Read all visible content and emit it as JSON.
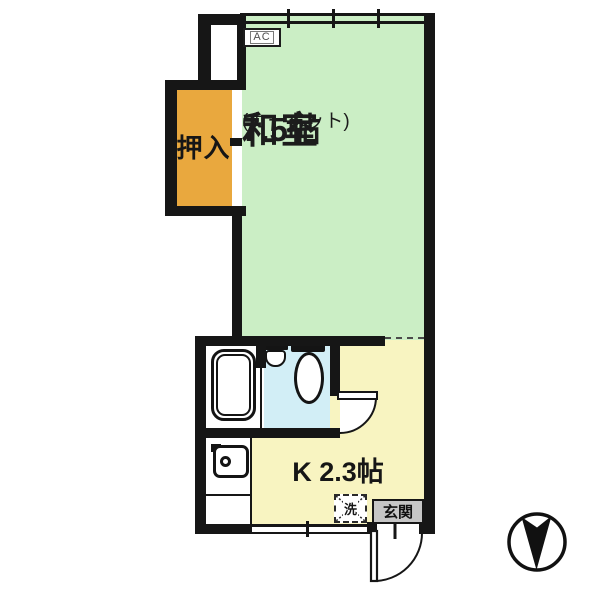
{
  "plan_type": "apartment-floor-plan",
  "labels": {
    "ac": "AC",
    "closet": "押入",
    "washer": "洗",
    "entrance": "玄関"
  },
  "rooms": {
    "washitsu": {
      "name": "和室",
      "note": "(カーペット)",
      "size": "7.5帖"
    },
    "kitchen": {
      "label": "K 2.3帖"
    }
  },
  "colors": {
    "wall": "#161616",
    "washitsu_fill": "#cbeec5",
    "closet_fill": "#e9a83e",
    "kitchen_fill": "#f8f4c1",
    "bath_fill": "#d2eef6",
    "bath_tub_zone_fill": "#ffffff",
    "entrance_fill": "#c6c6c6",
    "text": "#1c1c1c"
  },
  "icons": {
    "compass": "north-arrow-icon",
    "bathtub": "bathtub-icon",
    "toilet": "toilet-icon",
    "sink": "sink-icon",
    "stove": "stove-icon",
    "washer_cross": "washing-machine-place-icon"
  }
}
